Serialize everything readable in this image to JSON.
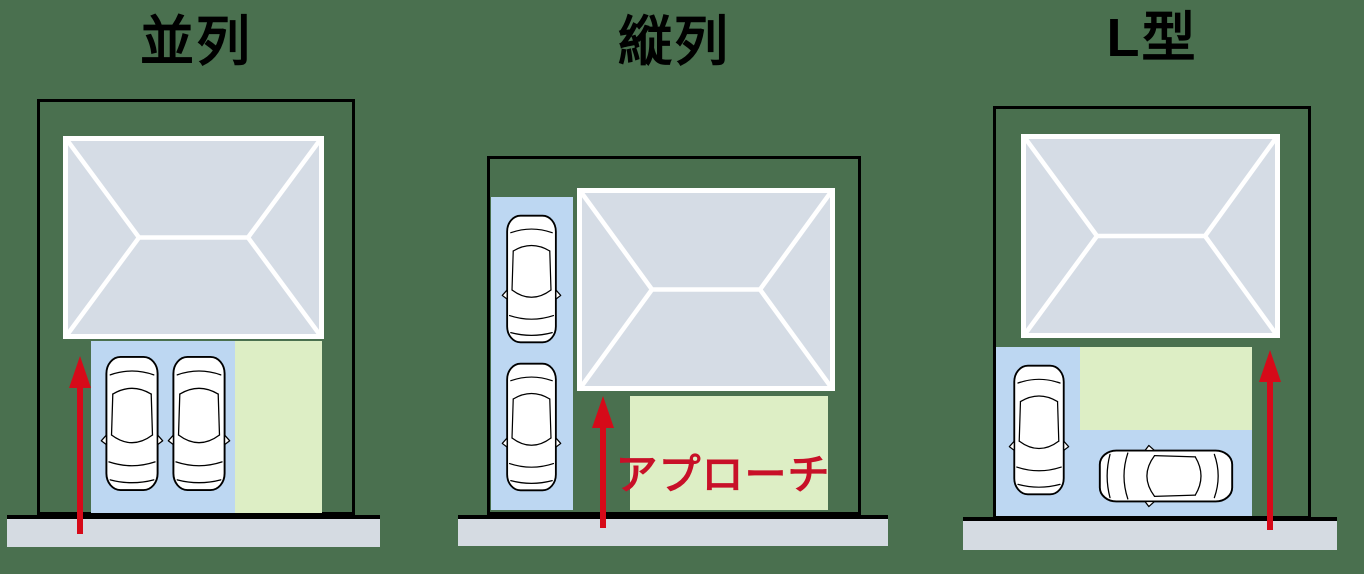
{
  "colors": {
    "background": "#4a704f",
    "outline": "#000000",
    "roof-fill": "#d5dce5",
    "roof-line": "#ffffff",
    "parking-fill": "#bdd7f2",
    "approach-fill": "#ddeec5",
    "sidewalk-fill": "#d5dbe2",
    "arrow-red": "#d60a19",
    "label-red": "#c81028",
    "car-fill": "#ffffff",
    "title-color": "#000000"
  },
  "panels": [
    {
      "id": "side-by-side",
      "title": "並列",
      "car_count": 2,
      "arrow_direction": "up"
    },
    {
      "id": "tandem",
      "title": "縦列",
      "car_count": 2,
      "arrow_direction": "up",
      "approach_label": "アプローチ"
    },
    {
      "id": "l-shape",
      "title": "L型",
      "car_count": 2,
      "arrow_direction": "up"
    }
  ]
}
